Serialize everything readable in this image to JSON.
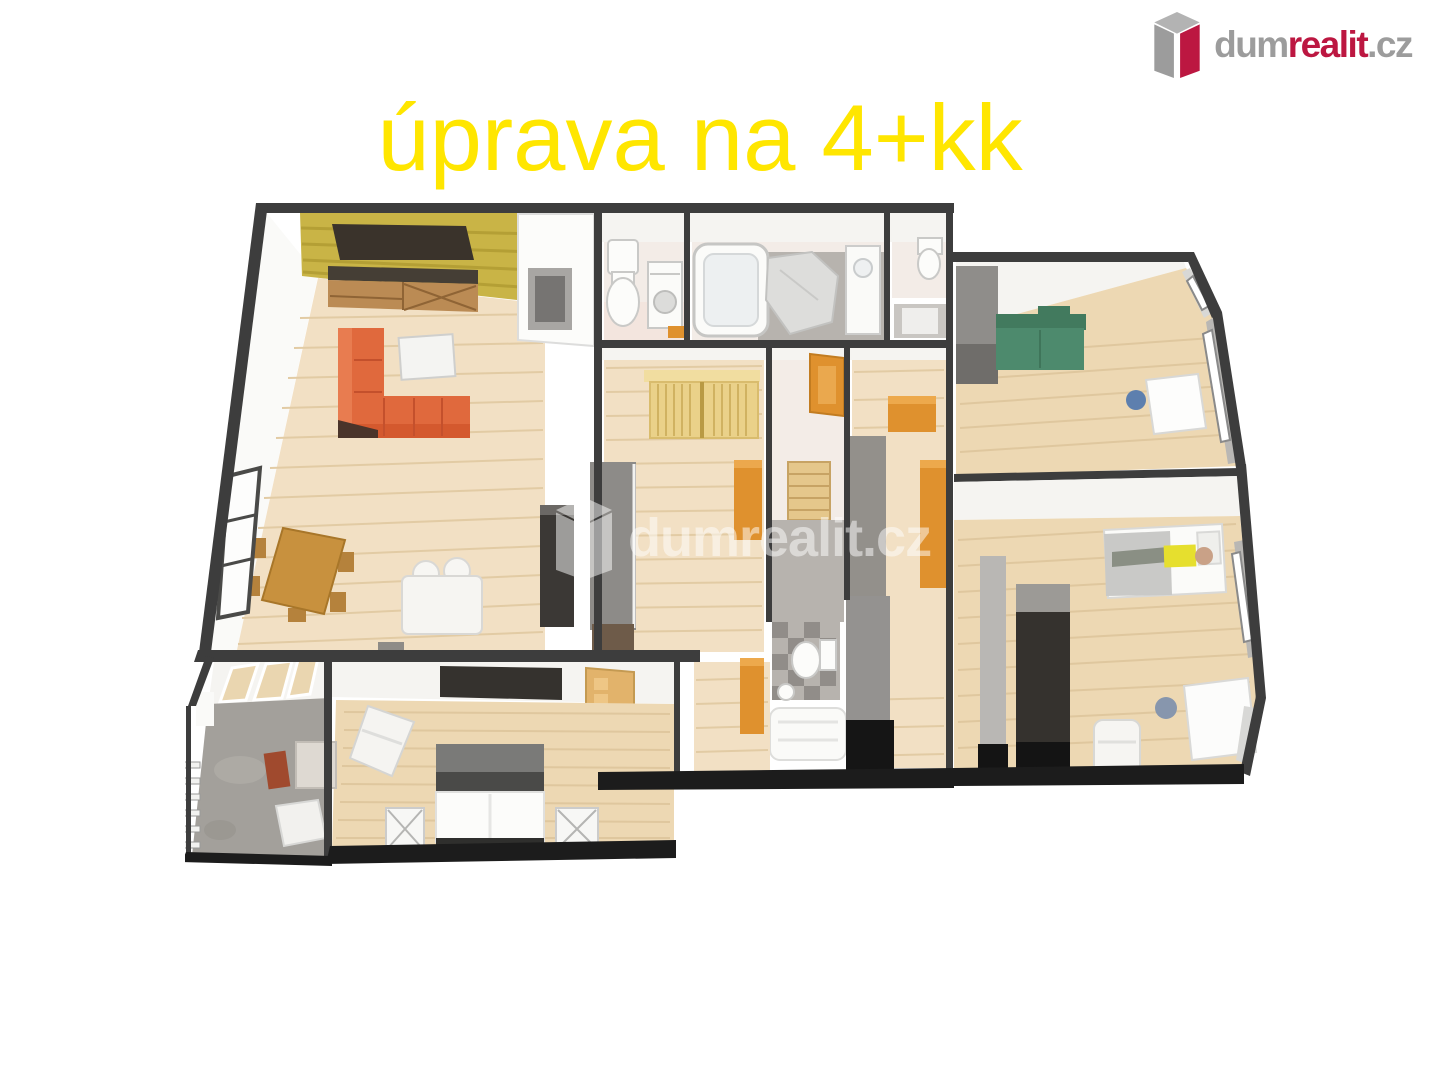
{
  "title": {
    "text": "úprava na 4+kk",
    "color": "#ffe600"
  },
  "logo": {
    "brand_dum": "dum",
    "brand_realit": "realit",
    "brand_cz": ".cz",
    "icon": "dumrealit-building-icon",
    "color_gray": "#9c9c9c",
    "color_red": "#bc1741"
  },
  "watermark": {
    "text": "dumrealit.cz",
    "icon": "dumrealit-building-icon",
    "color": "#ffffff",
    "opacity": "0.5"
  },
  "floorplan": {
    "kind": "3d-floor-plan-render",
    "palette": {
      "wall-dark": "#3d3d3d",
      "wall-face": "#f5f4f1",
      "exterior": "#1c1c1c",
      "floor-wood": "#f2e0c4",
      "floor-wood-line": "#e2cba4",
      "floor-carpet": "#edd8b3",
      "floor-carpet-line": "#dfc79e",
      "tile-gray": "#b7b3ae",
      "tile-light": "#f3ece7",
      "balcony-gray": "#a3a09b",
      "accent-wall": "#c9b446",
      "sofa-orange": "#e0693d",
      "sofa-green": "#4d8a6d",
      "cab-orange": "#df912e",
      "tan-wardrobe": "#ead189",
      "furn-dark": "#35322e",
      "wood-furn": "#c8913e",
      "white-furn": "#f9f8f5"
    }
  },
  "css_vars": {
    "title-color": "#ffe600",
    "logo-gray": "#9c9c9c",
    "logo-red": "#bc1741",
    "wm-opacity": "0.5"
  }
}
